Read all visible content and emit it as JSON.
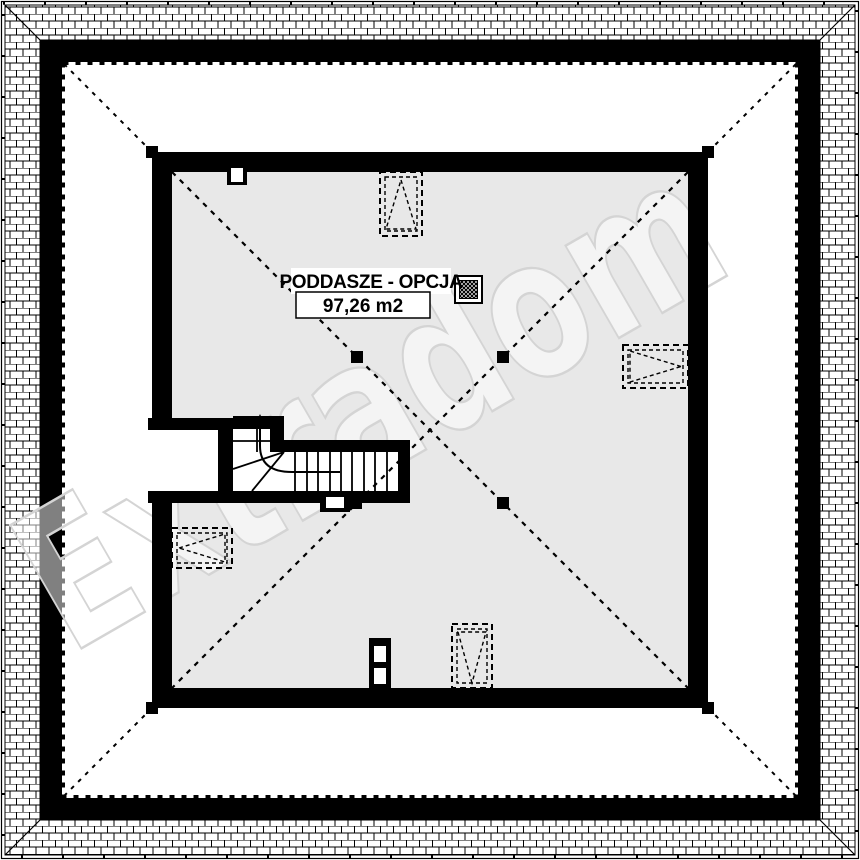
{
  "plan": {
    "title": "PODDASZE - OPCJA",
    "area_label": "97,26 m2",
    "watermark": "Extradom",
    "colors": {
      "background": "#ffffff",
      "floor_fill": "#e8e8e8",
      "line": "#000000",
      "watermark_stroke": "#d4d4d4"
    }
  }
}
